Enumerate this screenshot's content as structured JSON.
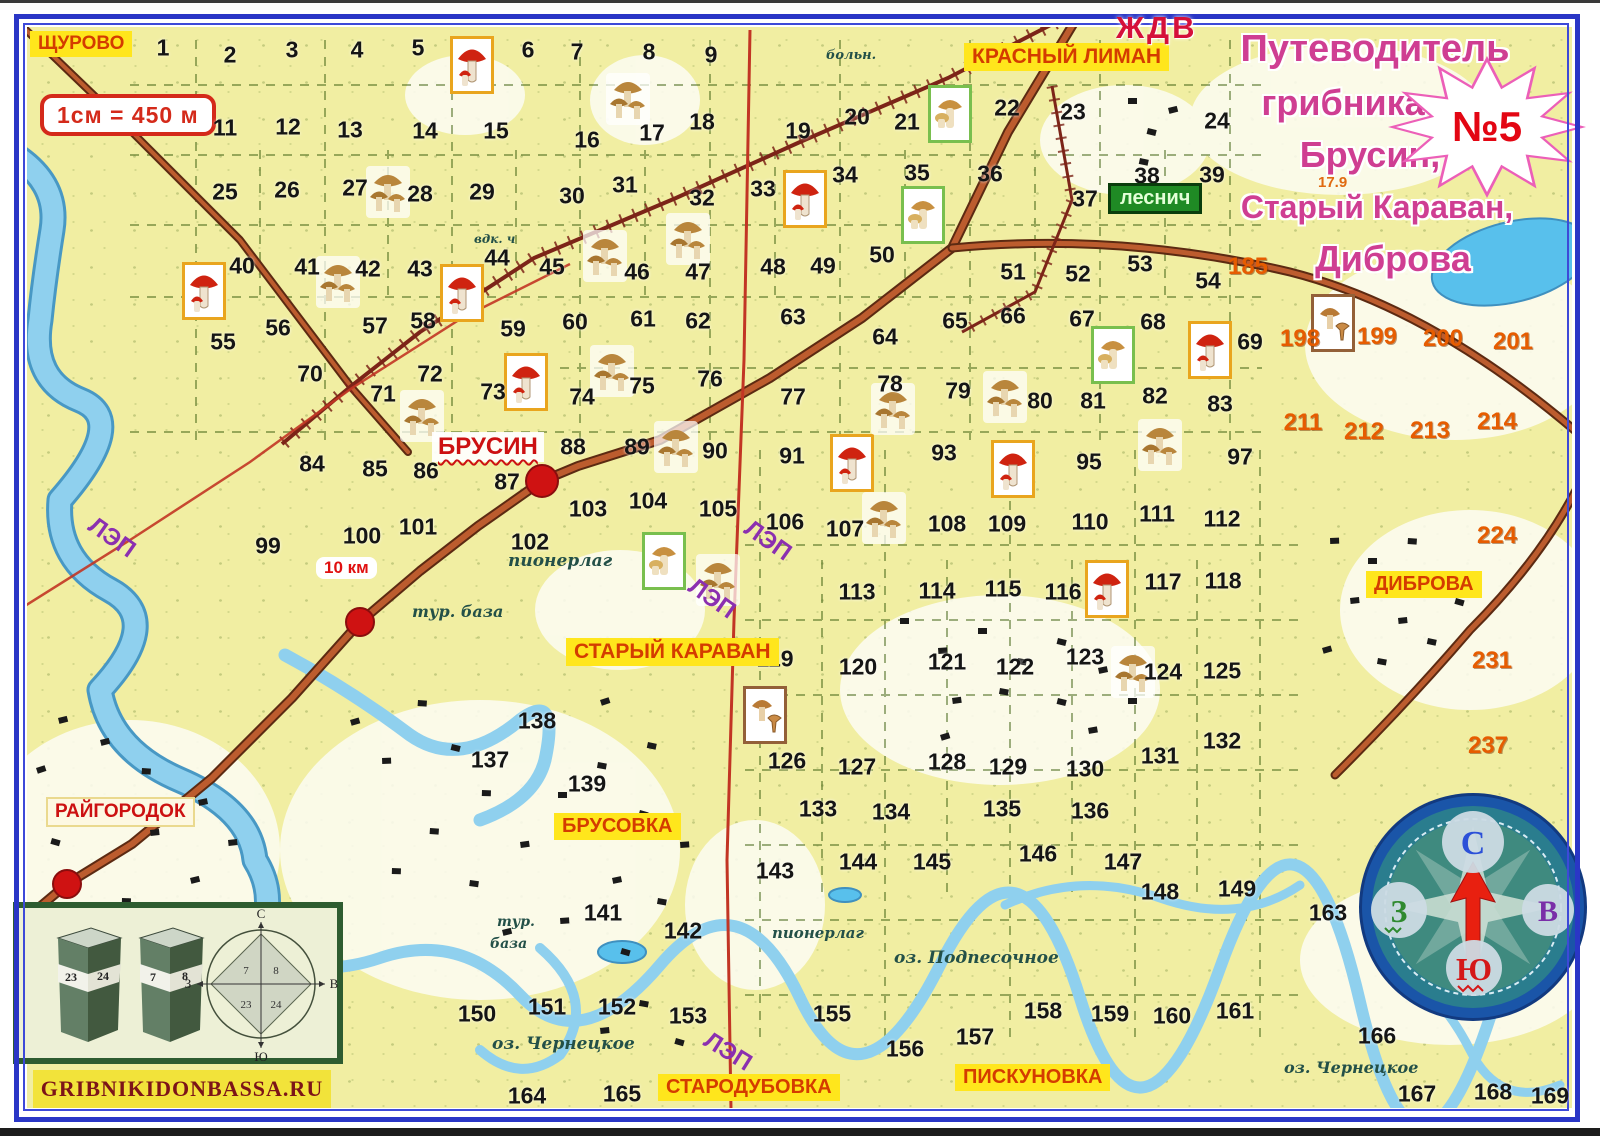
{
  "title": {
    "lines": [
      "Путеводитель",
      "грибника",
      "Брусин,",
      "Старый Караван,",
      "Диброва"
    ],
    "badge": "№5",
    "accent_color": "#cf3e92",
    "badge_color": "#e30613"
  },
  "scale_box": {
    "text": "1см = 450 м"
  },
  "power_line_label": "ЛЭП",
  "place_labels": [
    {
      "id": "schurovo",
      "text": "ЩУРОВО",
      "x": 30,
      "y": 31,
      "style": "yellow",
      "fs": 19
    },
    {
      "id": "krasny-liman",
      "text": "КРАСНЫЙ ЛИМАН",
      "x": 964,
      "y": 43,
      "style": "yellow",
      "fs": 21
    },
    {
      "id": "zhdv",
      "text": "ЖДВ",
      "x": 1116,
      "y": 10,
      "style": "plain-red",
      "fs": 31
    },
    {
      "id": "lesnich",
      "text": "леснич",
      "x": 1108,
      "y": 183,
      "style": "green",
      "fs": 20
    },
    {
      "id": "brusin",
      "text": "БРУСИН",
      "x": 432,
      "y": 432,
      "style": "white-wavy",
      "fs": 24
    },
    {
      "id": "stary-karavan",
      "text": "СТАРЫЙ КАРАВАН",
      "x": 566,
      "y": 638,
      "style": "yellow",
      "fs": 21
    },
    {
      "id": "dibrova",
      "text": "ДИБРОВА",
      "x": 1366,
      "y": 571,
      "style": "yellow",
      "fs": 20
    },
    {
      "id": "brusovka",
      "text": "БРУСОВКА",
      "x": 554,
      "y": 813,
      "style": "yellow",
      "fs": 20
    },
    {
      "id": "raygorodok",
      "text": "РАЙГОРОДОК",
      "x": 46,
      "y": 797,
      "style": "cream",
      "fs": 19
    },
    {
      "id": "starodubovka",
      "text": "СТАРОДУБОВКА",
      "x": 658,
      "y": 1074,
      "style": "yellow",
      "fs": 20
    },
    {
      "id": "piskunovka",
      "text": "ПИСКУНОВКА",
      "x": 955,
      "y": 1064,
      "style": "yellow",
      "fs": 20
    },
    {
      "id": "distance-note",
      "text": "10 км",
      "x": 316,
      "y": 557,
      "style": "note",
      "fs": 17
    },
    {
      "id": "route-mark",
      "text": "17.9",
      "x": 1318,
      "y": 174,
      "style": "orange-small",
      "fs": 15
    }
  ],
  "map_texts": [
    [
      "больн.",
      826,
      48,
      13
    ],
    [
      "вдк. ч",
      474,
      232,
      12
    ],
    [
      "пионерлаг",
      508,
      551,
      17
    ],
    [
      "тур. база",
      412,
      602,
      16
    ],
    [
      "тур.",
      497,
      914,
      14
    ],
    [
      "база",
      490,
      936,
      14
    ],
    [
      "пионерлаг",
      772,
      924,
      15
    ],
    [
      "оз. Подпесочное",
      894,
      948,
      17
    ],
    [
      "оз. Чернецкое",
      492,
      1034,
      17
    ],
    [
      "оз. Чернецкое",
      1284,
      1058,
      16
    ]
  ],
  "power_line_labels": [
    [
      86,
      524,
      35
    ],
    [
      742,
      527,
      35
    ],
    [
      686,
      585,
      35
    ],
    [
      702,
      1038,
      32
    ]
  ],
  "grid_numbers": [
    [
      1,
      163,
      48
    ],
    [
      2,
      230,
      55
    ],
    [
      3,
      292,
      50
    ],
    [
      4,
      357,
      50
    ],
    [
      5,
      418,
      48
    ],
    [
      6,
      528,
      50
    ],
    [
      7,
      577,
      52
    ],
    [
      8,
      649,
      52
    ],
    [
      9,
      711,
      55
    ],
    [
      11,
      225,
      128
    ],
    [
      12,
      288,
      127
    ],
    [
      13,
      350,
      130
    ],
    [
      14,
      425,
      131
    ],
    [
      15,
      496,
      131
    ],
    [
      16,
      587,
      140
    ],
    [
      17,
      652,
      133
    ],
    [
      18,
      702,
      122
    ],
    [
      19,
      798,
      131
    ],
    [
      20,
      857,
      117
    ],
    [
      21,
      907,
      122
    ],
    [
      22,
      1007,
      108
    ],
    [
      23,
      1073,
      112
    ],
    [
      24,
      1217,
      121
    ],
    [
      25,
      225,
      192
    ],
    [
      26,
      287,
      190
    ],
    [
      27,
      355,
      188
    ],
    [
      28,
      420,
      194
    ],
    [
      29,
      482,
      192
    ],
    [
      30,
      572,
      196
    ],
    [
      31,
      625,
      185
    ],
    [
      32,
      702,
      198
    ],
    [
      33,
      763,
      189
    ],
    [
      34,
      845,
      175
    ],
    [
      35,
      917,
      173
    ],
    [
      36,
      990,
      174
    ],
    [
      37,
      1085,
      199
    ],
    [
      38,
      1147,
      176
    ],
    [
      39,
      1212,
      175
    ],
    [
      40,
      242,
      266
    ],
    [
      41,
      307,
      267
    ],
    [
      42,
      368,
      269
    ],
    [
      43,
      420,
      269
    ],
    [
      44,
      497,
      258
    ],
    [
      45,
      552,
      267
    ],
    [
      46,
      637,
      272
    ],
    [
      47,
      698,
      272
    ],
    [
      48,
      773,
      267
    ],
    [
      49,
      823,
      266
    ],
    [
      50,
      882,
      255
    ],
    [
      51,
      1013,
      272
    ],
    [
      52,
      1078,
      274
    ],
    [
      53,
      1140,
      264
    ],
    [
      54,
      1208,
      281
    ],
    [
      55,
      223,
      342
    ],
    [
      56,
      278,
      328
    ],
    [
      57,
      375,
      326
    ],
    [
      58,
      423,
      321
    ],
    [
      59,
      513,
      329
    ],
    [
      60,
      575,
      322
    ],
    [
      61,
      643,
      319
    ],
    [
      62,
      698,
      321
    ],
    [
      63,
      793,
      317
    ],
    [
      64,
      885,
      337
    ],
    [
      65,
      955,
      321
    ],
    [
      66,
      1013,
      316
    ],
    [
      67,
      1082,
      319
    ],
    [
      68,
      1153,
      322
    ],
    [
      69,
      1250,
      342
    ],
    [
      70,
      310,
      374
    ],
    [
      71,
      383,
      394
    ],
    [
      72,
      430,
      374
    ],
    [
      73,
      493,
      392
    ],
    [
      74,
      582,
      397
    ],
    [
      75,
      642,
      386
    ],
    [
      76,
      710,
      379
    ],
    [
      77,
      793,
      397
    ],
    [
      78,
      890,
      384
    ],
    [
      79,
      958,
      391
    ],
    [
      80,
      1040,
      401
    ],
    [
      81,
      1093,
      401
    ],
    [
      82,
      1155,
      396
    ],
    [
      83,
      1220,
      404
    ],
    [
      84,
      312,
      464
    ],
    [
      85,
      375,
      469
    ],
    [
      86,
      426,
      471
    ],
    [
      87,
      507,
      482
    ],
    [
      88,
      573,
      447
    ],
    [
      89,
      637,
      447
    ],
    [
      90,
      715,
      451
    ],
    [
      91,
      792,
      456
    ],
    [
      93,
      944,
      453
    ],
    [
      95,
      1089,
      462
    ],
    [
      97,
      1240,
      457
    ],
    [
      99,
      268,
      546
    ],
    [
      100,
      362,
      536
    ],
    [
      101,
      418,
      527
    ],
    [
      102,
      530,
      542
    ],
    [
      103,
      588,
      509
    ],
    [
      104,
      648,
      501
    ],
    [
      105,
      718,
      509
    ],
    [
      106,
      785,
      522
    ],
    [
      107,
      845,
      529
    ],
    [
      108,
      947,
      524
    ],
    [
      109,
      1007,
      524
    ],
    [
      110,
      1090,
      522
    ],
    [
      111,
      1157,
      514
    ],
    [
      112,
      1222,
      519
    ],
    [
      113,
      857,
      592
    ],
    [
      114,
      937,
      591
    ],
    [
      115,
      1003,
      589
    ],
    [
      116,
      1063,
      592
    ],
    [
      117,
      1163,
      582
    ],
    [
      118,
      1223,
      581
    ],
    [
      119,
      775,
      659
    ],
    [
      120,
      858,
      667
    ],
    [
      121,
      947,
      662
    ],
    [
      122,
      1015,
      667
    ],
    [
      123,
      1085,
      657
    ],
    [
      124,
      1163,
      672
    ],
    [
      125,
      1222,
      671
    ],
    [
      126,
      787,
      761
    ],
    [
      127,
      857,
      767
    ],
    [
      128,
      947,
      762
    ],
    [
      129,
      1008,
      767
    ],
    [
      130,
      1085,
      769
    ],
    [
      131,
      1160,
      756
    ],
    [
      132,
      1222,
      741
    ],
    [
      133,
      818,
      809
    ],
    [
      134,
      891,
      812
    ],
    [
      135,
      1002,
      809
    ],
    [
      136,
      1090,
      811
    ],
    [
      137,
      490,
      760
    ],
    [
      138,
      537,
      721
    ],
    [
      139,
      587,
      784
    ],
    [
      141,
      603,
      913
    ],
    [
      142,
      683,
      931
    ],
    [
      143,
      775,
      871
    ],
    [
      144,
      858,
      862
    ],
    [
      145,
      932,
      862
    ],
    [
      146,
      1038,
      854
    ],
    [
      147,
      1123,
      862
    ],
    [
      148,
      1160,
      892
    ],
    [
      149,
      1237,
      889
    ],
    [
      150,
      477,
      1014
    ],
    [
      151,
      547,
      1007
    ],
    [
      152,
      617,
      1007
    ],
    [
      153,
      688,
      1016
    ],
    [
      155,
      832,
      1014
    ],
    [
      156,
      905,
      1049
    ],
    [
      157,
      975,
      1037
    ],
    [
      158,
      1043,
      1011
    ],
    [
      159,
      1110,
      1014
    ],
    [
      160,
      1172,
      1016
    ],
    [
      161,
      1235,
      1011
    ],
    [
      163,
      1328,
      913
    ],
    [
      164,
      527,
      1096
    ],
    [
      165,
      622,
      1094
    ],
    [
      166,
      1377,
      1036
    ],
    [
      167,
      1417,
      1094
    ],
    [
      168,
      1493,
      1092
    ],
    [
      169,
      1550,
      1096
    ]
  ],
  "orange_numbers": [
    [
      185,
      1248,
      267
    ],
    [
      198,
      1300,
      339
    ],
    [
      199,
      1377,
      337
    ],
    [
      200,
      1443,
      339
    ],
    [
      201,
      1513,
      342
    ],
    [
      211,
      1303,
      423
    ],
    [
      212,
      1364,
      432
    ],
    [
      213,
      1430,
      431
    ],
    [
      214,
      1497,
      422
    ],
    [
      224,
      1497,
      536
    ],
    [
      231,
      1492,
      661
    ],
    [
      237,
      1488,
      746
    ]
  ],
  "mushroom_markers": [
    [
      "red",
      450,
      36
    ],
    [
      "red",
      783,
      170
    ],
    [
      "red",
      182,
      262
    ],
    [
      "red",
      440,
      264
    ],
    [
      "red",
      504,
      353
    ],
    [
      "red",
      1188,
      321
    ],
    [
      "red",
      830,
      434
    ],
    [
      "red",
      991,
      440
    ],
    [
      "red",
      1085,
      560
    ],
    [
      "pale",
      928,
      85
    ],
    [
      "pale",
      901,
      186
    ],
    [
      "pale",
      1091,
      326
    ],
    [
      "pale",
      642,
      532
    ],
    [
      "brown",
      743,
      686
    ],
    [
      "brown",
      1311,
      294
    ],
    [
      "cluster",
      606,
      73
    ],
    [
      "cluster",
      366,
      166
    ],
    [
      "cluster",
      316,
      256
    ],
    [
      "cluster",
      583,
      230
    ],
    [
      "cluster",
      666,
      213
    ],
    [
      "cluster",
      400,
      390
    ],
    [
      "cluster",
      590,
      345
    ],
    [
      "cluster",
      871,
      383
    ],
    [
      "cluster",
      983,
      371
    ],
    [
      "cluster",
      654,
      421
    ],
    [
      "cluster",
      862,
      492
    ],
    [
      "cluster",
      1138,
      419
    ],
    [
      "cluster",
      1111,
      646
    ],
    [
      "cluster",
      696,
      554
    ]
  ],
  "route_points": [
    [
      542,
      481,
      17
    ],
    [
      360,
      622,
      15
    ],
    [
      67,
      884,
      15
    ]
  ],
  "compass": {
    "n": "С",
    "s": "Ю",
    "w": "З",
    "e": "В"
  },
  "legend": {
    "post_a": [
      "23",
      "24"
    ],
    "post_b": [
      "7",
      "8"
    ],
    "letters": {
      "n": "С",
      "s": "Ю",
      "w": "З",
      "e": "В"
    },
    "quadrants": [
      "7",
      "8",
      "23",
      "24"
    ],
    "site": "GRIBNIKIDONBASSA.RU"
  }
}
